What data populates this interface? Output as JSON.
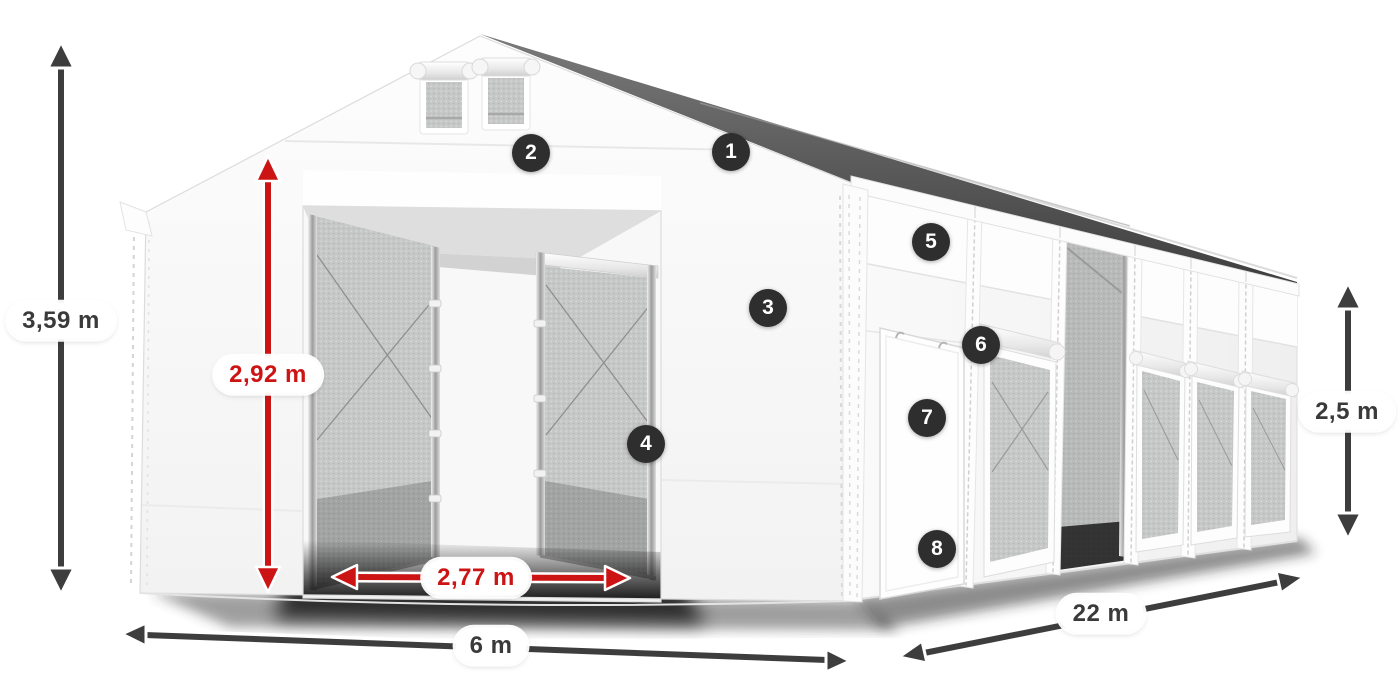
{
  "diagram": {
    "badges": [
      "1",
      "2",
      "3",
      "4",
      "5",
      "6",
      "7",
      "8"
    ],
    "dimensions": {
      "total_height": "3,59 m",
      "entrance_height": "2,92 m",
      "entrance_width": "2,77 m",
      "front_width": "6 m",
      "side_length": "22 m",
      "side_wall_height": "2,5 m"
    },
    "colors": {
      "accent_red": "#cc1414",
      "arrow_gray": "#3d3d3d",
      "badge_background": "#2e2e2e",
      "badge_text": "#ffffff",
      "fabric_white": "#f7f7f7",
      "mesh_gray": "#c6c7c7"
    }
  }
}
